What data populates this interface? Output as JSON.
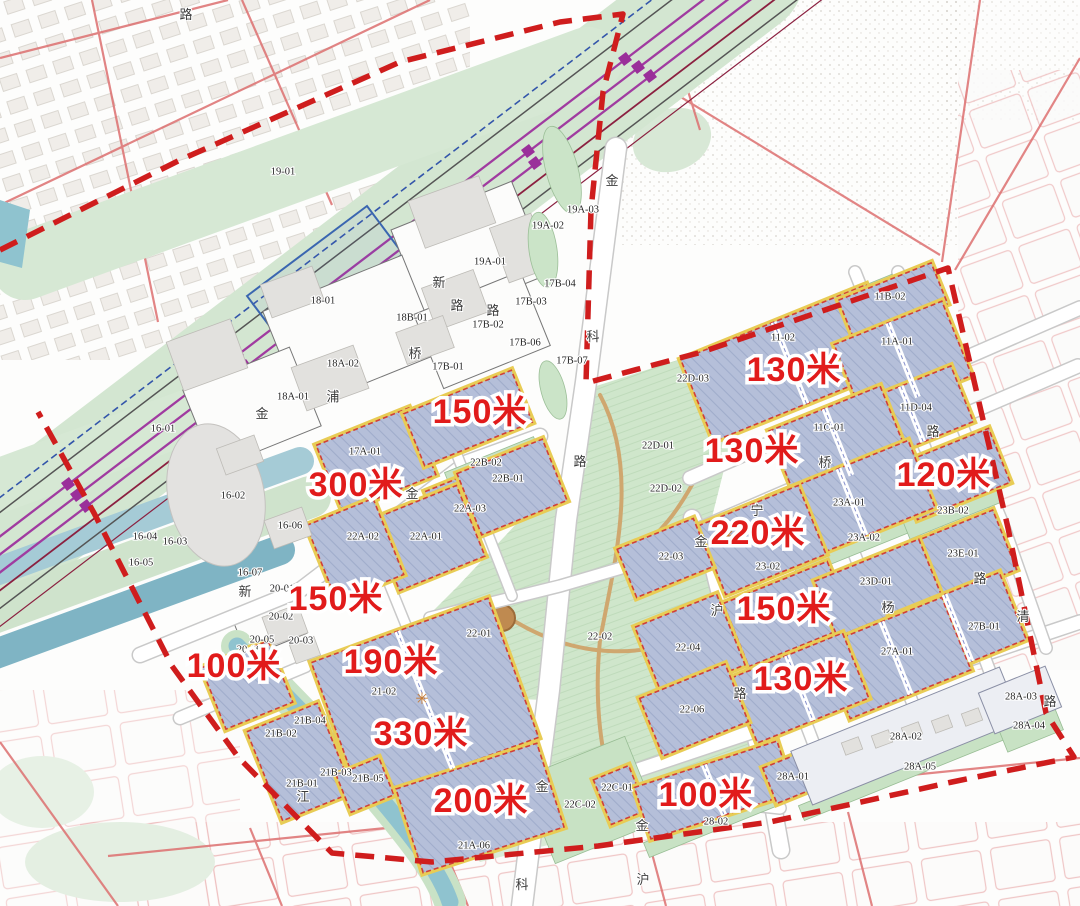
{
  "map": {
    "title": "regulatory master plan with building height limits",
    "colors": {
      "boundary": "#cf1d1d",
      "height_text": "#e11b1b",
      "parcel_fill": "#b5bfd9",
      "parcel_outline": "#d04038",
      "setback_yellow": "#e8cc55",
      "park_green": "#cfe6cb",
      "water_teal": "#8fc3cf",
      "rail_purple": "#a03ba0"
    },
    "height_labels": [
      {
        "t": "150米",
        "x": 480,
        "y": 414
      },
      {
        "t": "300米",
        "x": 356,
        "y": 487
      },
      {
        "t": "150米",
        "x": 336,
        "y": 601
      },
      {
        "t": "100米",
        "x": 234,
        "y": 668
      },
      {
        "t": "190米",
        "x": 391,
        "y": 664
      },
      {
        "t": "330米",
        "x": 421,
        "y": 736
      },
      {
        "t": "200米",
        "x": 481,
        "y": 803
      },
      {
        "t": "100米",
        "x": 706,
        "y": 797
      },
      {
        "t": "130米",
        "x": 794,
        "y": 372
      },
      {
        "t": "130米",
        "x": 752,
        "y": 453
      },
      {
        "t": "120米",
        "x": 944,
        "y": 477
      },
      {
        "t": "220米",
        "x": 758,
        "y": 535
      },
      {
        "t": "150米",
        "x": 784,
        "y": 611
      },
      {
        "t": "130米",
        "x": 801,
        "y": 681
      }
    ],
    "parcel_labels": [
      {
        "t": "19-01",
        "x": 283,
        "y": 172
      },
      {
        "t": "19A-03",
        "x": 583,
        "y": 210
      },
      {
        "t": "19A-02",
        "x": 548,
        "y": 226
      },
      {
        "t": "19A-01",
        "x": 490,
        "y": 262
      },
      {
        "t": "18-01",
        "x": 323,
        "y": 301
      },
      {
        "t": "18B-01",
        "x": 412,
        "y": 318
      },
      {
        "t": "18A-02",
        "x": 343,
        "y": 364
      },
      {
        "t": "18A-01",
        "x": 293,
        "y": 397
      },
      {
        "t": "17B-04",
        "x": 560,
        "y": 284
      },
      {
        "t": "17B-03",
        "x": 531,
        "y": 302
      },
      {
        "t": "17B-02",
        "x": 488,
        "y": 325
      },
      {
        "t": "17B-06",
        "x": 525,
        "y": 343
      },
      {
        "t": "17B-01",
        "x": 448,
        "y": 367
      },
      {
        "t": "17B-07",
        "x": 572,
        "y": 361
      },
      {
        "t": "16-01",
        "x": 163,
        "y": 429
      },
      {
        "t": "16-02",
        "x": 233,
        "y": 496
      },
      {
        "t": "16-06",
        "x": 290,
        "y": 526
      },
      {
        "t": "16-04",
        "x": 145,
        "y": 537
      },
      {
        "t": "16-03",
        "x": 175,
        "y": 542
      },
      {
        "t": "16-05",
        "x": 141,
        "y": 563
      },
      {
        "t": "16-07",
        "x": 250,
        "y": 573
      },
      {
        "t": "17A-01",
        "x": 365,
        "y": 452
      },
      {
        "t": "22A-03",
        "x": 470,
        "y": 509
      },
      {
        "t": "22A-01",
        "x": 426,
        "y": 537
      },
      {
        "t": "22A-02",
        "x": 363,
        "y": 537
      },
      {
        "t": "22B-01",
        "x": 508,
        "y": 479
      },
      {
        "t": "22B-02",
        "x": 486,
        "y": 463
      },
      {
        "t": "22D-03",
        "x": 693,
        "y": 379
      },
      {
        "t": "22D-01",
        "x": 658,
        "y": 446
      },
      {
        "t": "22D-02",
        "x": 666,
        "y": 489
      },
      {
        "t": "22-01",
        "x": 479,
        "y": 634
      },
      {
        "t": "22-02",
        "x": 600,
        "y": 637
      },
      {
        "t": "22-03",
        "x": 671,
        "y": 557
      },
      {
        "t": "22-04",
        "x": 688,
        "y": 648
      },
      {
        "t": "22-06",
        "x": 692,
        "y": 710
      },
      {
        "t": "20-01",
        "x": 282,
        "y": 589
      },
      {
        "t": "20-02",
        "x": 281,
        "y": 617
      },
      {
        "t": "20-05",
        "x": 262,
        "y": 640
      },
      {
        "t": "20-06",
        "x": 249,
        "y": 650
      },
      {
        "t": "20-03",
        "x": 301,
        "y": 641
      },
      {
        "t": "21-02",
        "x": 384,
        "y": 692
      },
      {
        "t": "21B-04",
        "x": 310,
        "y": 721
      },
      {
        "t": "21B-02",
        "x": 281,
        "y": 734
      },
      {
        "t": "21B-03",
        "x": 336,
        "y": 773
      },
      {
        "t": "21B-05",
        "x": 368,
        "y": 779
      },
      {
        "t": "21B-01",
        "x": 302,
        "y": 784
      },
      {
        "t": "21A-06",
        "x": 474,
        "y": 846
      },
      {
        "t": "22C-01",
        "x": 617,
        "y": 788
      },
      {
        "t": "22C-02",
        "x": 580,
        "y": 805
      },
      {
        "t": "28-02",
        "x": 716,
        "y": 822
      },
      {
        "t": "11B-02",
        "x": 890,
        "y": 297
      },
      {
        "t": "11-02",
        "x": 783,
        "y": 338
      },
      {
        "t": "11A-01",
        "x": 897,
        "y": 342
      },
      {
        "t": "11D-04",
        "x": 916,
        "y": 408
      },
      {
        "t": "11C-01",
        "x": 829,
        "y": 428
      },
      {
        "t": "23A-01",
        "x": 849,
        "y": 503
      },
      {
        "t": "23A-02",
        "x": 864,
        "y": 538
      },
      {
        "t": "23B-02",
        "x": 953,
        "y": 511
      },
      {
        "t": "23E-01",
        "x": 963,
        "y": 554
      },
      {
        "t": "23-02",
        "x": 768,
        "y": 567
      },
      {
        "t": "23D-01",
        "x": 876,
        "y": 582
      },
      {
        "t": "27B-01",
        "x": 984,
        "y": 627
      },
      {
        "t": "27A-01",
        "x": 897,
        "y": 652
      },
      {
        "t": "28A-01",
        "x": 793,
        "y": 777
      },
      {
        "t": "28A-02",
        "x": 906,
        "y": 737
      },
      {
        "t": "28A-03",
        "x": 1021,
        "y": 697
      },
      {
        "t": "28A-04",
        "x": 1029,
        "y": 726
      },
      {
        "t": "28A-05",
        "x": 920,
        "y": 767
      }
    ],
    "road_labels": [
      {
        "t": "路",
        "x": 186,
        "y": 16
      },
      {
        "t": "金",
        "x": 612,
        "y": 182
      },
      {
        "t": "科",
        "x": 593,
        "y": 338
      },
      {
        "t": "路",
        "x": 580,
        "y": 463
      },
      {
        "t": "新",
        "x": 439,
        "y": 284
      },
      {
        "t": "路",
        "x": 457,
        "y": 307
      },
      {
        "t": "桥",
        "x": 415,
        "y": 355
      },
      {
        "t": "路",
        "x": 493,
        "y": 312
      },
      {
        "t": "浦",
        "x": 333,
        "y": 398
      },
      {
        "t": "金",
        "x": 412,
        "y": 495
      },
      {
        "t": "金",
        "x": 262,
        "y": 415
      },
      {
        "t": "新",
        "x": 245,
        "y": 593
      },
      {
        "t": "江",
        "x": 303,
        "y": 798
      },
      {
        "t": "金",
        "x": 542,
        "y": 788
      },
      {
        "t": "科",
        "x": 522,
        "y": 886
      },
      {
        "t": "金",
        "x": 642,
        "y": 827
      },
      {
        "t": "沪",
        "x": 643,
        "y": 881
      },
      {
        "t": "金",
        "x": 701,
        "y": 543
      },
      {
        "t": "沪",
        "x": 717,
        "y": 612
      },
      {
        "t": "路",
        "x": 740,
        "y": 695
      },
      {
        "t": "桥",
        "x": 825,
        "y": 464
      },
      {
        "t": "宁",
        "x": 757,
        "y": 512
      },
      {
        "t": "杨",
        "x": 888,
        "y": 609
      },
      {
        "t": "路",
        "x": 933,
        "y": 433
      },
      {
        "t": "路",
        "x": 980,
        "y": 580
      },
      {
        "t": "清",
        "x": 1023,
        "y": 618
      },
      {
        "t": "路",
        "x": 1050,
        "y": 703
      }
    ],
    "markers": [
      {
        "t": "✳",
        "x": 422,
        "y": 700
      },
      {
        "t": "✳",
        "x": 728,
        "y": 537
      }
    ]
  }
}
